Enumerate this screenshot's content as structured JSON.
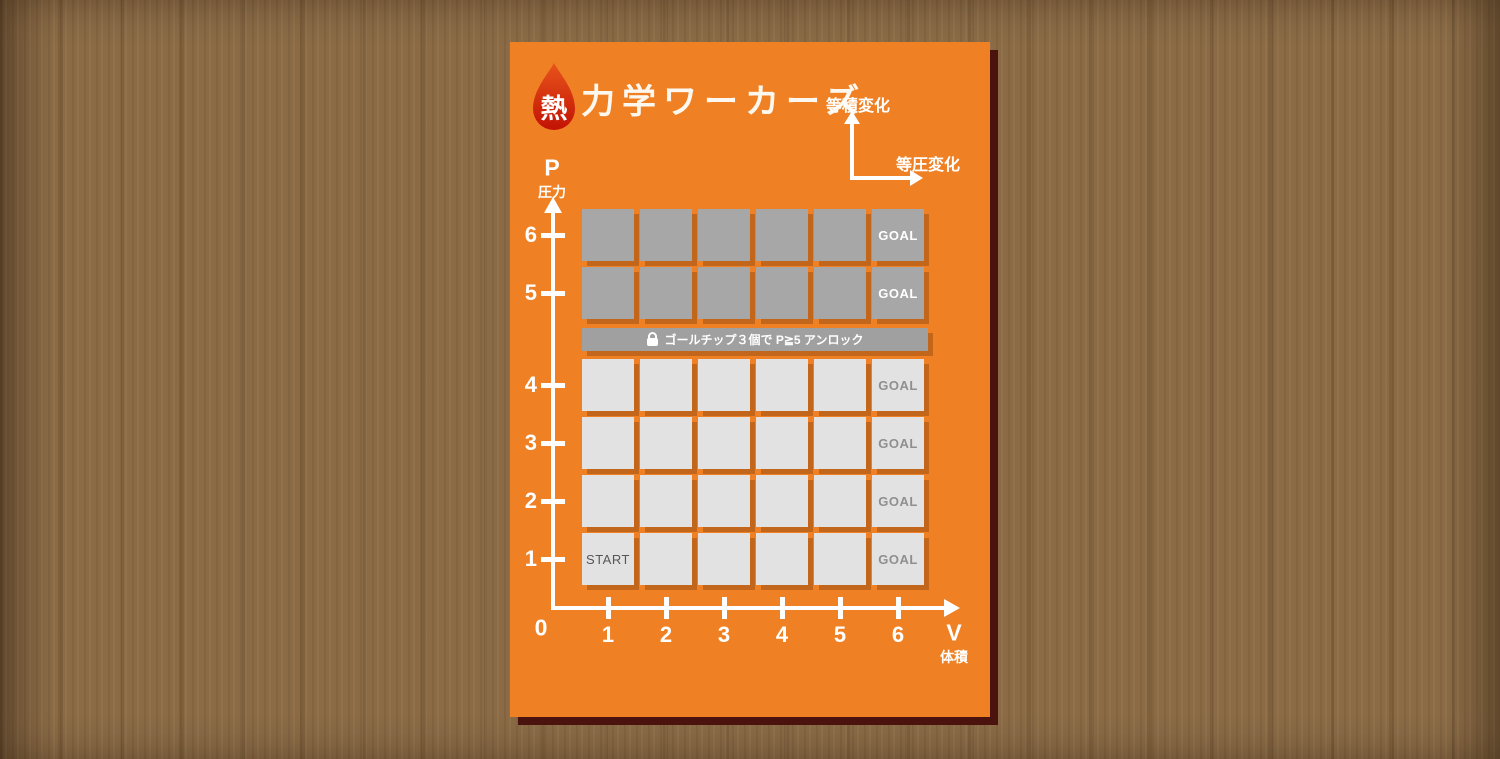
{
  "card": {
    "title": {
      "drop_char": "熱",
      "text": "力学ワーカーズ"
    },
    "legend": {
      "isochoric": "等積変化",
      "isobaric": "等圧変化"
    },
    "axes": {
      "p_symbol": "P",
      "p_name": "圧力",
      "v_symbol": "V",
      "v_name": "体積",
      "origin": "0",
      "p_ticks": [
        "6",
        "5",
        "4",
        "3",
        "2",
        "1"
      ],
      "v_ticks": [
        "1",
        "2",
        "3",
        "4",
        "5",
        "6"
      ]
    },
    "lock_bar": {
      "icon": "lock-icon",
      "text": "ゴールチップ３個で P≧5 アンロック"
    },
    "grid": {
      "rows": [
        {
          "p": "6",
          "locked": true,
          "cells": [
            "",
            "",
            "",
            "",
            "",
            "GOAL"
          ]
        },
        {
          "p": "5",
          "locked": true,
          "cells": [
            "",
            "",
            "",
            "",
            "",
            "GOAL"
          ]
        },
        {
          "p": "4",
          "locked": false,
          "cells": [
            "",
            "",
            "",
            "",
            "",
            "GOAL"
          ]
        },
        {
          "p": "3",
          "locked": false,
          "cells": [
            "",
            "",
            "",
            "",
            "",
            "GOAL"
          ]
        },
        {
          "p": "2",
          "locked": false,
          "cells": [
            "",
            "",
            "",
            "",
            "",
            "GOAL"
          ]
        },
        {
          "p": "1",
          "locked": false,
          "cells": [
            "START",
            "",
            "",
            "",
            "",
            "GOAL"
          ]
        }
      ],
      "start_label": "START",
      "goal_label": "GOAL"
    },
    "colors": {
      "card_bg": "#ef8124",
      "card_shadow": "#4a130d",
      "cell_shadow": "#c2661b",
      "cell_open": "#e2e2e2",
      "cell_locked": "#a7a7a7",
      "lock_bar_bg": "#a0a0a0",
      "goal_text_open": "#8f8f8f",
      "start_text": "#565656",
      "drop_red_top": "#e8541c",
      "drop_red_bottom": "#c21204",
      "wood": "#8a6b46"
    }
  }
}
